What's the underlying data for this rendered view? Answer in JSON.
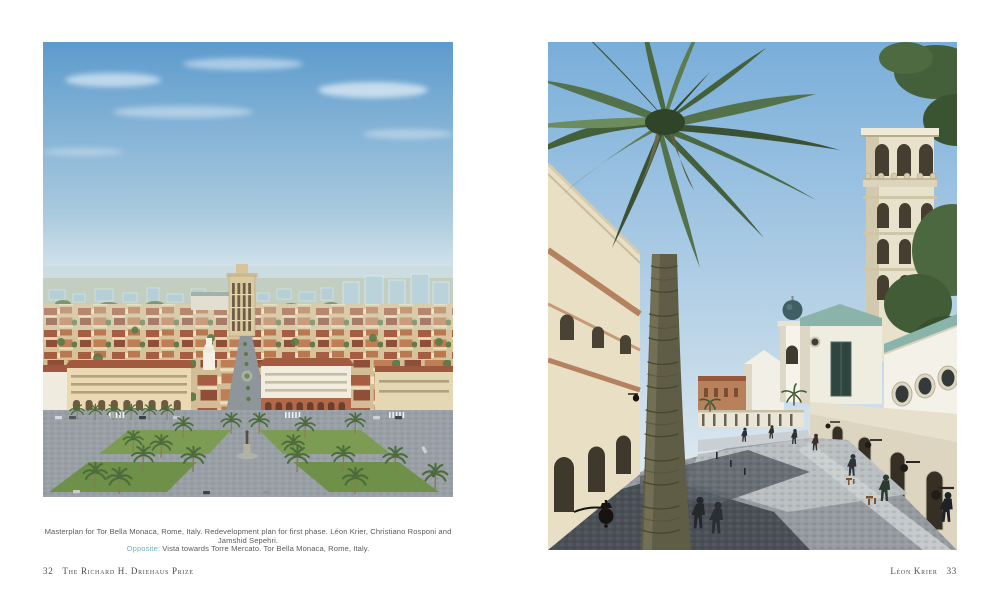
{
  "spread": {
    "left_page": {
      "plate_alt": "Aerial view rendering of the Tor Bella Monaca masterplan, Rome",
      "caption": {
        "line1": "Masterplan for Tor Bella Monaca, Rome, Italy. Redevelopment plan for first phase. Léon Krier, Christiano Rosponi and Jamshid Sepehri.",
        "line2_label": "Opposite:",
        "line2_text": " Vista towards Torre Mercato. Tor Bella Monaca, Rome, Italy."
      },
      "folio": "32",
      "running_title": "The Richard H. Driehaus Prize"
    },
    "right_page": {
      "plate_alt": "Street-level rendering, vista towards Torre Mercato with palm tree and campanile",
      "running_title": "Léon Krier",
      "folio": "33"
    },
    "colors": {
      "caption_label_accent": "#74b3c0",
      "caption_text": "#5a5b5d",
      "folio_text": "#4c4c4c",
      "page_background": "#ffffff"
    }
  }
}
